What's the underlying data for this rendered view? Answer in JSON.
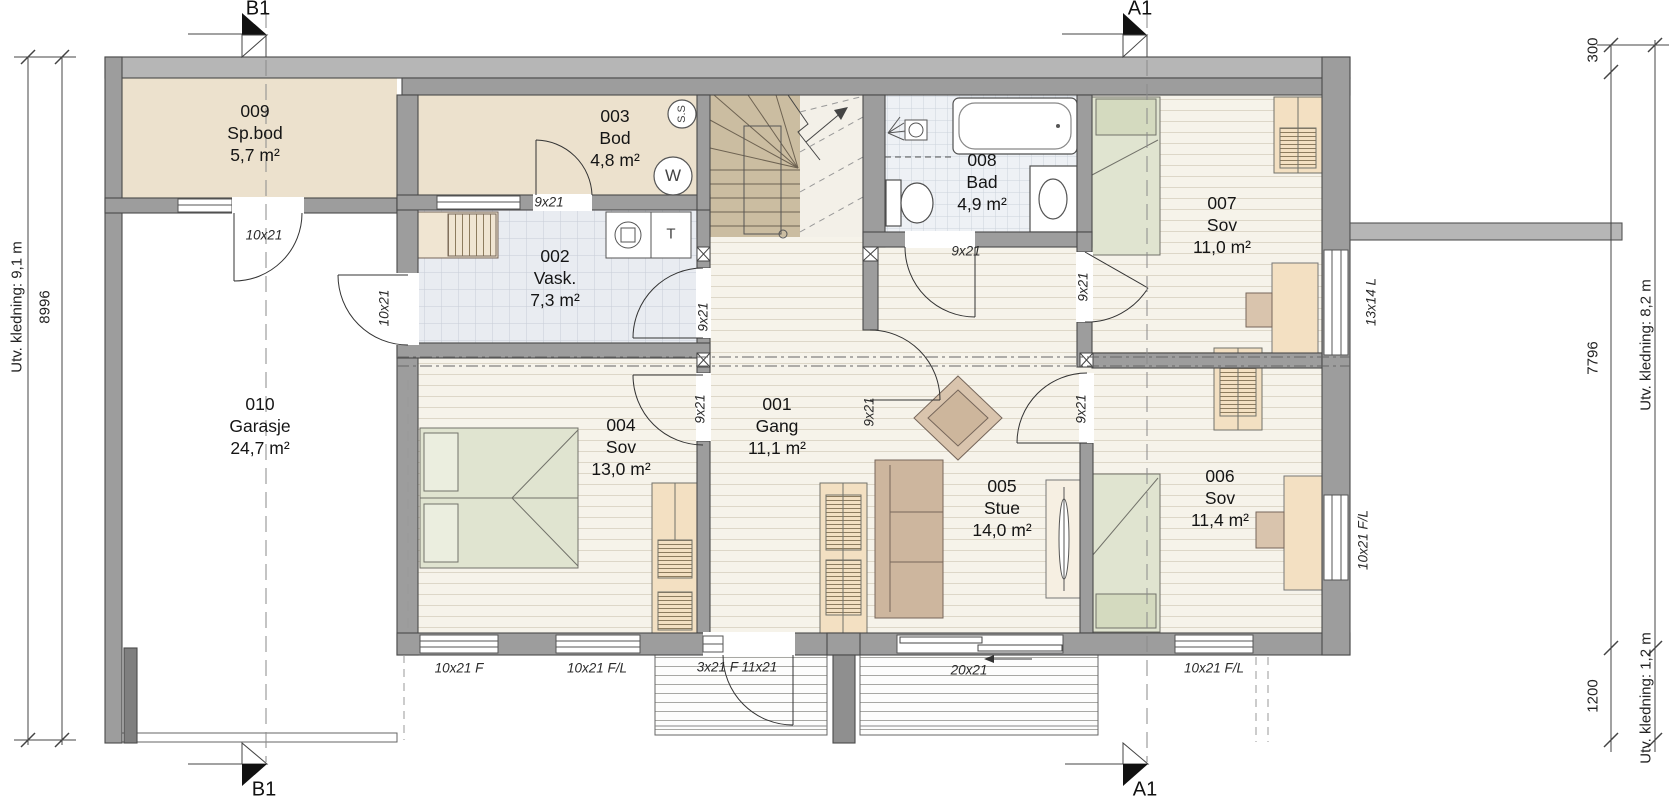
{
  "plan": {
    "sections": {
      "b1": "B1",
      "a1": "A1"
    },
    "dimensions": {
      "left_outer": "Utv. kledning: 9,1 m",
      "left_inner": "8996",
      "right_300": "300",
      "right_7796": "7796",
      "right_1200": "1200",
      "right_outer_top": "Utv. kledning: 8,2 m",
      "right_outer_bottom": "Utv. kledning: 1,2 m"
    }
  },
  "rooms": [
    {
      "id": "009",
      "name": "Sp.bod",
      "area": "5,7 m²",
      "x": 255,
      "y": 100
    },
    {
      "id": "003",
      "name": "Bod",
      "area": "4,8 m²",
      "x": 615,
      "y": 105
    },
    {
      "id": "008",
      "name": "Bad",
      "area": "4,9 m²",
      "x": 982,
      "y": 149
    },
    {
      "id": "002",
      "name": "Vask.",
      "area": "7,3 m²",
      "x": 555,
      "y": 245
    },
    {
      "id": "007",
      "name": "Sov",
      "area": "11,0 m²",
      "x": 1222,
      "y": 192
    },
    {
      "id": "010",
      "name": "Garasje",
      "area": "24,7 m²",
      "x": 260,
      "y": 393
    },
    {
      "id": "004",
      "name": "Sov",
      "area": "13,0 m²",
      "x": 621,
      "y": 414
    },
    {
      "id": "001",
      "name": "Gang",
      "area": "11,1 m²",
      "x": 777,
      "y": 393
    },
    {
      "id": "005",
      "name": "Stue",
      "area": "14,0 m²",
      "x": 1002,
      "y": 475
    },
    {
      "id": "006",
      "name": "Sov",
      "area": "11,4 m²",
      "x": 1220,
      "y": 465
    }
  ],
  "opening_labels": [
    {
      "text": "10x21",
      "x": 264,
      "y": 235,
      "rot": 0
    },
    {
      "text": "10x21",
      "x": 384,
      "y": 308,
      "rot": -90
    },
    {
      "text": "9x21",
      "x": 549,
      "y": 202,
      "rot": 0
    },
    {
      "text": "9x21",
      "x": 703,
      "y": 317,
      "rot": -90
    },
    {
      "text": "9x21",
      "x": 700,
      "y": 409,
      "rot": -90
    },
    {
      "text": "9x21",
      "x": 869,
      "y": 412,
      "rot": -90
    },
    {
      "text": "9x21",
      "x": 966,
      "y": 251,
      "rot": 0
    },
    {
      "text": "9x21",
      "x": 1083,
      "y": 287,
      "rot": -90
    },
    {
      "text": "9x21",
      "x": 1081,
      "y": 409,
      "rot": -90
    },
    {
      "text": "13x14 L",
      "x": 1371,
      "y": 302,
      "rot": -90
    },
    {
      "text": "10x21 F/L",
      "x": 1363,
      "y": 540,
      "rot": -90
    },
    {
      "text": "10x21 F",
      "x": 459,
      "y": 668,
      "rot": 0
    },
    {
      "text": "10x21 F/L",
      "x": 597,
      "y": 668,
      "rot": 0
    },
    {
      "text": "3x21 F 11x21",
      "x": 737,
      "y": 667,
      "rot": 0
    },
    {
      "text": "20x21",
      "x": 969,
      "y": 670,
      "rot": 0
    },
    {
      "text": "10x21 F/L",
      "x": 1214,
      "y": 668,
      "rot": 0
    }
  ],
  "appliance_labels": [
    {
      "text": "S.S",
      "x": 682,
      "y": 114,
      "rot": -90,
      "size": 11
    },
    {
      "text": "W",
      "x": 673,
      "y": 176,
      "rot": 0,
      "size": 17
    },
    {
      "text": "T",
      "x": 671,
      "y": 234,
      "rot": 0,
      "size": 15
    }
  ]
}
